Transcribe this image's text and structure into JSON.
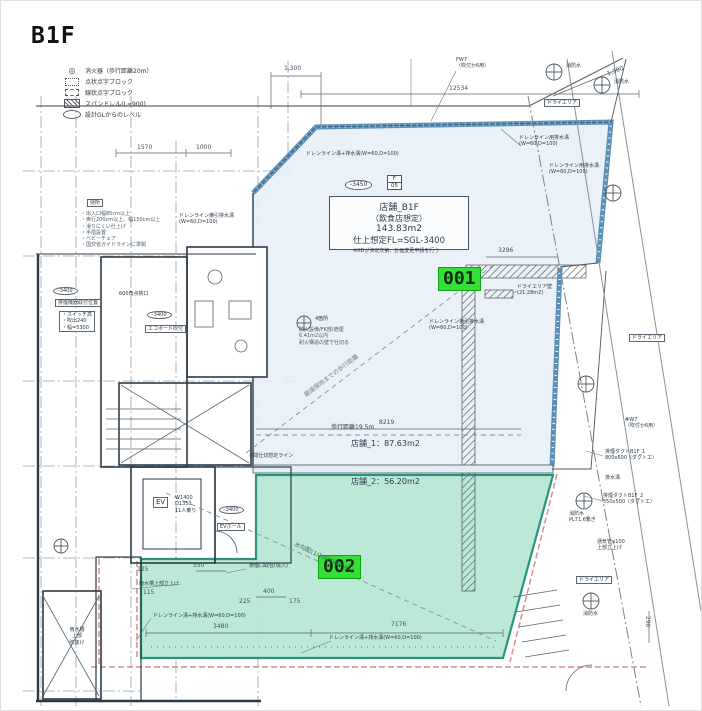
{
  "title": "B1F",
  "legend": {
    "items": [
      {
        "icon": "fire-extinguisher",
        "label": "消火器（歩行距離20m）"
      },
      {
        "icon": "dot-braille-block",
        "label": "点状点字ブロック"
      },
      {
        "icon": "line-braille-block",
        "label": "線状点字ブロック"
      },
      {
        "icon": "spandrel-hatch",
        "label": "スパンドレル(L=900)"
      },
      {
        "icon": "level-oval",
        "label": "設計GLからのレベル"
      }
    ]
  },
  "rooms": {
    "main": {
      "line1": "店舗_B1F",
      "line2": "（飲食店想定）",
      "line3": "143.83m2",
      "line4": "仕上想定FL=SGL-3400",
      "note": "※KDが決定次第、計画変更申請を行う"
    },
    "room1_area": "店舗_1：87.63m2",
    "room2_area": "店舗_2：56.20m2"
  },
  "badges": {
    "unit1": "001",
    "unit2": "002"
  },
  "levels": {
    "l3450": "-3450",
    "l3400": "-3400",
    "door_top": "F",
    "door_bottom": "05"
  },
  "labels": {
    "walk19": "歩行距離19.5m",
    "walk_far": "最遠隔地までの歩行距離",
    "slope": "水勾配(1/100勾配) 水上",
    "partition": "※間仕切想定ライン",
    "dry_wall": "ドライエリア壁\n(21.28m2)",
    "dry_area": "ドライエリア",
    "drain1": "ドレンライン用排水溝\n(W=60,D=100)",
    "drain2": "ドレンライン横引排水溝\n(W=60,D=100)",
    "drain3": "ドレンライン溝+排水溝(W=60,D=100)",
    "inspection": "600角点検口",
    "fire_count": "4箇所",
    "fire_note": "防火設備/FK部/遮煙\n6.41m2以内\n耐火構造の壁で仕切る",
    "ev": "EV",
    "ev_spec": "W1400\nD1350\n11人乗り",
    "ev_hall": "EVホール",
    "rain_up": "雨水槽上部立上げ",
    "rain_void": "雨水槽\n上部\n吹抜け",
    "smoke_duct1": "排煙ダクトB1F_1\n800x600（ダクト工）",
    "smoke_duct2": "排煙ダクトB1F_2\n550x500（ダクト工）",
    "ditch": "排水溝",
    "fw7": "FW7\n（吹付か6用）",
    "w7": "#W7\n（吹付か6用）",
    "fire_water": "消防水",
    "fire_water2": "消防水\nPL71.6繋ぎ",
    "vent": "通気管φ100\n上部立上げ",
    "smoke_in": "排煙口取合(吸入)",
    "toilet_title": "便所",
    "toilet_note": "・出入口幅85cm以上\n・奥行200cm以上、幅150cm以上\n・滑りにくい仕上げ\n・手摺設置\n・ベビーチェア\n・国交省ガイドラインに準拠",
    "mech_title": "排煙機器取付位置",
    "mech_note": "・スイッチ高\n・吹出240\n・幅=5300",
    "eco": "エコボード吹付"
  },
  "dims": {
    "d1300": "1,300",
    "d12534": "12534",
    "d1570": "1570",
    "d1000": "1000",
    "d8219": "8219",
    "d3296": "3296",
    "d7176": "7176",
    "d3480": "3480",
    "d550": "550",
    "d400": "400",
    "d225": "225",
    "d175": "175",
    "d115": "115",
    "d125": "125",
    "d290": "290"
  },
  "colors": {
    "highlight_green": "#35df35",
    "room_blue_fill": "#e8f0f7",
    "room_green_fill": "#b9e7d6",
    "green_border": "#1f8f7a",
    "wall_blue": "#5c8fb5",
    "boundary_pink": "#d98c8c"
  }
}
